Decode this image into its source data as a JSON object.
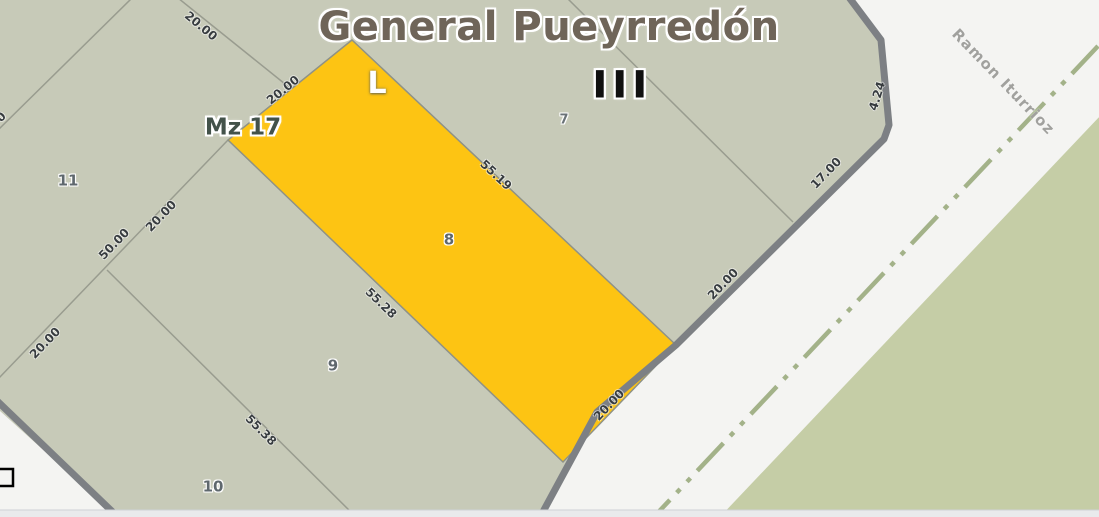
{
  "map": {
    "title": "General Pueyrredón",
    "zone_label": "III",
    "block_label": "Mz 17",
    "letter_label": "L",
    "street_name": "Ramon Iturrioz",
    "highlighted_parcel": "8",
    "parcel_numbers": {
      "p7": "7",
      "p8": "8",
      "p9": "9",
      "p10": "10",
      "p11": "11"
    },
    "dimensions": {
      "top_20": "20.00",
      "p8_front_top": "20.00",
      "p8_side_ne": "55.19",
      "p8_side_sw": "55.28",
      "p8_front_road": "20.00",
      "p7_front_road": "20.00",
      "p7_side_17": "17.00",
      "corner_chamfer": "4.24",
      "west_upper_20": "20.00",
      "west_50": "50.00",
      "west_lower_20": "20.00",
      "p9_p10_side": "55.38",
      "edge_fragment": "0"
    }
  },
  "colors": {
    "road": "#f4f4f2",
    "block_fill": "#c7cab8",
    "adjacent_block_fill": "#c5cda6",
    "parcel_highlight": "#fdc413",
    "parcel_highlight_stroke": "#8f9286",
    "block_border": "#7d8084",
    "parcel_line": "#999c8f",
    "road_centerline": "#a3b289",
    "bottom_strip": "#e9eaec",
    "bottom_strip_line": "#ced1d6",
    "title_text": "#6f6559",
    "block_label_text": "#43524a",
    "parcel_number_text": "#5f686e",
    "dimension_text": "#373c3f",
    "street_text": "#a1a19e",
    "zone_text": "#101010",
    "letter_text": "#ffffff",
    "corner_mark": "#000000"
  }
}
